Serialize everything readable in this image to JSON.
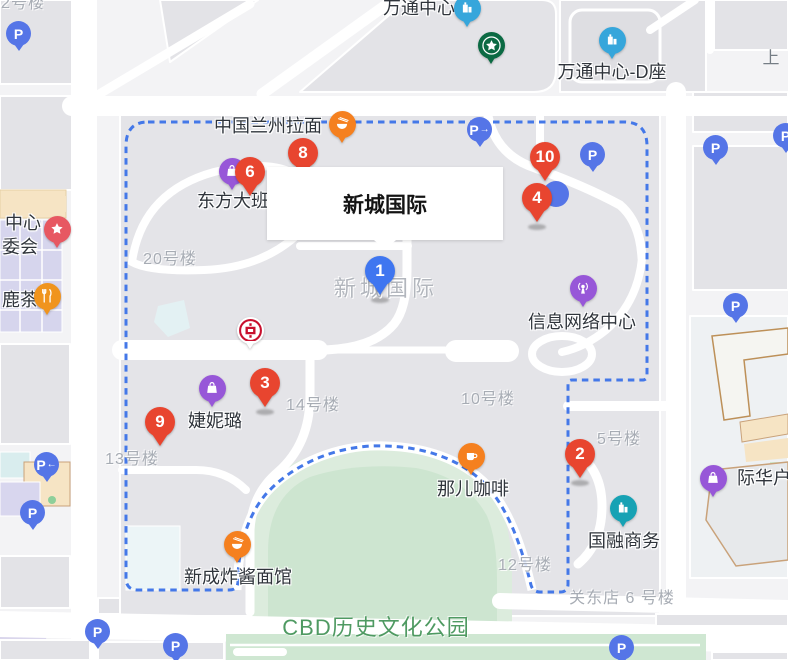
{
  "infobox": {
    "title": "新城国际"
  },
  "colors": {
    "marker_red": "#e8452f",
    "marker_blue": "#3f76f0",
    "parking_blue": "#5575e7",
    "poi_orange": "#f5801f",
    "poi_orange_deep": "#f0941d",
    "poi_purple": "#9757d8",
    "poi_blue": "#36a6db",
    "poi_teal": "#17a2b4",
    "poi_star_red": "#e75862",
    "starbucks_green": "#0b6a43",
    "boundary_blue": "#4478e8"
  },
  "numbered_markers": [
    {
      "num": "1",
      "color": "blue",
      "x": 380,
      "y": 271,
      "shadow": true
    },
    {
      "num": "2",
      "color": "red",
      "x": 580,
      "y": 454,
      "shadow": true
    },
    {
      "num": "3",
      "color": "red",
      "x": 265,
      "y": 383,
      "shadow": true
    },
    {
      "num": "4",
      "color": "red",
      "x": 537,
      "y": 198,
      "shadow": true
    },
    {
      "num": "6",
      "color": "red",
      "x": 250,
      "y": 172,
      "shadow": false
    },
    {
      "num": "8",
      "color": "red",
      "x": 303,
      "y": 153,
      "shadow": false
    },
    {
      "num": "9",
      "color": "red",
      "x": 160,
      "y": 422,
      "shadow": false
    },
    {
      "num": "10",
      "color": "red",
      "x": 545,
      "y": 157,
      "shadow": false
    }
  ],
  "pois": [
    {
      "id": "wantong-center",
      "label": "万通中心",
      "icon": "building",
      "color": "#36a6db",
      "x": 467,
      "y": 8,
      "label_x": 419,
      "label_y": 7
    },
    {
      "id": "starbucks",
      "label": "",
      "icon": "starbucks",
      "color": "#0b6a43",
      "x": 491,
      "y": 45
    },
    {
      "id": "wantong-d",
      "label": "万通中心-D座",
      "icon": "building",
      "color": "#36a6db",
      "x": 612,
      "y": 40,
      "label_x": 612,
      "label_y": 71
    },
    {
      "id": "lanzhou-noodle",
      "label": "中国兰州拉面",
      "icon": "noodles",
      "color": "#f5801f",
      "x": 342,
      "y": 124,
      "label_x": 268,
      "label_y": 125
    },
    {
      "id": "dongfang-daban",
      "label": "东方大班",
      "icon": "bag",
      "color": "#9757d8",
      "x": 232,
      "y": 171,
      "label_x": 233,
      "label_y": 200
    },
    {
      "id": "bank-of-china",
      "label": "",
      "icon": "boc",
      "color": "#ffffff",
      "x": 250,
      "y": 330
    },
    {
      "id": "jienilu",
      "label": "婕妮璐",
      "icon": "bag",
      "color": "#9757d8",
      "x": 212,
      "y": 388,
      "label_x": 215,
      "label_y": 420
    },
    {
      "id": "nar-coffee",
      "label": "那儿咖啡",
      "icon": "coffee",
      "color": "#f5801f",
      "x": 471,
      "y": 456,
      "label_x": 473,
      "label_y": 488
    },
    {
      "id": "xincheng-zhajiang",
      "label": "新成炸酱面馆",
      "icon": "noodles",
      "color": "#f5801f",
      "x": 237,
      "y": 544,
      "label_x": 238,
      "label_y": 576
    },
    {
      "id": "guorong-business",
      "label": "国融商务",
      "icon": "building",
      "color": "#17a2b4",
      "x": 623,
      "y": 508,
      "label_x": 624,
      "label_y": 540
    },
    {
      "id": "info-network",
      "label": "信息网络中心",
      "icon": "network",
      "color": "#9757d8",
      "x": 583,
      "y": 288,
      "label_x": 582,
      "label_y": 321
    },
    {
      "id": "jihua",
      "label": "际华户",
      "icon": "bag",
      "color": "#9757d8",
      "x": 713,
      "y": 478,
      "label_x": 764,
      "label_y": 477
    },
    {
      "id": "lucha",
      "label": "鹿茶",
      "icon": "cutlery",
      "color": "#f0941d",
      "x": 47,
      "y": 296,
      "label_x": 20,
      "label_y": 299
    },
    {
      "id": "community-star",
      "label": "",
      "icon": "star",
      "color": "#e75862",
      "x": 57,
      "y": 229
    }
  ],
  "text_labels": [
    {
      "text": "中心",
      "x": 23,
      "y": 222,
      "cls": "poi"
    },
    {
      "text": "委会",
      "x": 20,
      "y": 246,
      "cls": "poi"
    },
    {
      "text": "上",
      "x": 771,
      "y": 56,
      "cls": "street"
    },
    {
      "text": "2号楼",
      "x": 23,
      "y": 1,
      "cls": "bldg"
    },
    {
      "text": "20号楼",
      "x": 170,
      "y": 257,
      "cls": "bldg"
    },
    {
      "text": "14号楼",
      "x": 313,
      "y": 403,
      "cls": "bldg"
    },
    {
      "text": "13号楼",
      "x": 132,
      "y": 457,
      "cls": "bldg"
    },
    {
      "text": "10号楼",
      "x": 488,
      "y": 397,
      "cls": "bldg"
    },
    {
      "text": "5号楼",
      "x": 619,
      "y": 437,
      "cls": "bldg"
    },
    {
      "text": "12号楼",
      "x": 525,
      "y": 563,
      "cls": "bldg"
    },
    {
      "text": "关东店 6 号楼",
      "x": 622,
      "y": 596,
      "cls": "bldg"
    },
    {
      "text": "新城国际",
      "x": 386,
      "y": 287,
      "cls": "area"
    },
    {
      "text": "CBD历史文化公园",
      "x": 376,
      "y": 626,
      "cls": "park"
    }
  ],
  "parkings": [
    {
      "x": 19,
      "y": 34
    },
    {
      "x": 480,
      "y": 130,
      "arrow": "right"
    },
    {
      "x": 593,
      "y": 155
    },
    {
      "x": 716,
      "y": 148
    },
    {
      "x": 786,
      "y": 136
    },
    {
      "x": 736,
      "y": 306
    },
    {
      "x": 47,
      "y": 465,
      "arrow": "left"
    },
    {
      "x": 33,
      "y": 513
    },
    {
      "x": 98,
      "y": 632
    },
    {
      "x": 176,
      "y": 646
    },
    {
      "x": 622,
      "y": 648
    },
    {
      "x": 556,
      "y": 194,
      "circleOnly": true
    }
  ]
}
